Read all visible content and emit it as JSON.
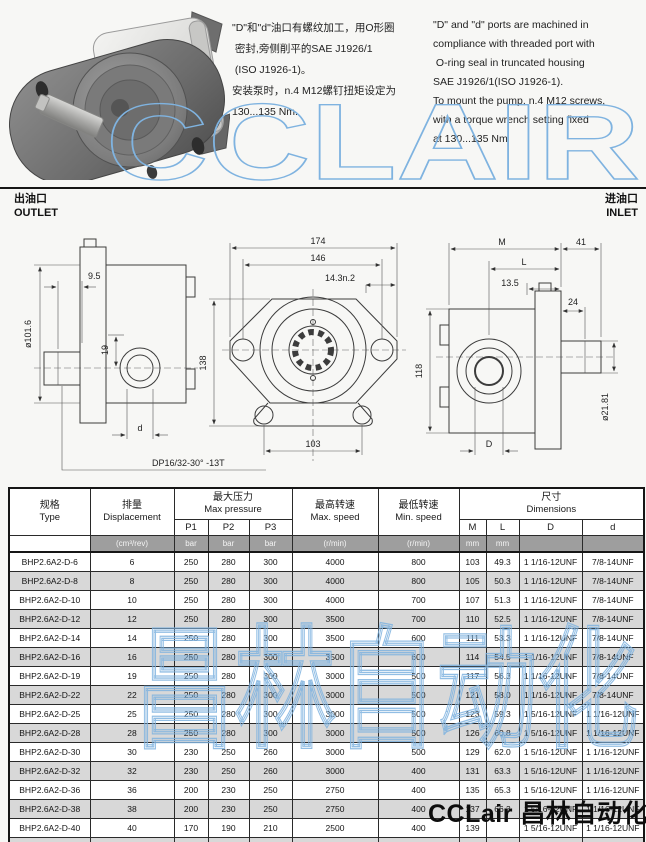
{
  "header": {
    "notes_zh": [
      "\"D\"和\"d\"油口有螺纹加工，用O形圈",
      " 密封,旁侧削平的SAE J1926/1",
      " (ISO J1926-1)。",
      "安装泵时，n.4 M12螺钉扭矩设定为",
      "130...135 Nm."
    ],
    "notes_en": [
      "\"D\" and \"d\" ports are machined in",
      "compliance with threaded port with",
      " O-ring seal in truncated housing",
      "SAE J1926/1(ISO J1926-1).",
      "To mount the pump, n.4 M12 screws,",
      "with a torque wrench setting fixed",
      "at 130...135 Nm"
    ]
  },
  "watermarks": {
    "brand_outline": "CCLAIR",
    "table_outline": "昌林自动化",
    "footer_black": "CCLair 昌林自动化",
    "outline_color": "#7fb3e0"
  },
  "ports": {
    "outlet_zh": "出油口",
    "outlet_en": "OUTLET",
    "inlet_zh": "进油口",
    "inlet_en": "INLET"
  },
  "drawing": {
    "dims": {
      "w95": "9.5",
      "dia1016": "ø101.6",
      "h19": "19",
      "h138": "138",
      "d_small": "d",
      "spline": "DP16/32-30°  -13T",
      "w174": "174",
      "w146": "146",
      "w143": "14.3n.2",
      "w103": "103",
      "M": "M",
      "w41": "41",
      "L": "L",
      "w135": "13.5",
      "w24": "24",
      "h118": "118",
      "dia2181": "ø21.81",
      "D_big": "D"
    }
  },
  "table": {
    "headers": {
      "type_zh": "规格",
      "type_en": "Type",
      "disp_zh": "排量",
      "disp_en": "Displacement",
      "press_zh": "最大压力",
      "press_en": "Max pressure",
      "p1": "P1",
      "p2": "P2",
      "p3": "P3",
      "maxspeed_zh": "最高转速",
      "maxspeed_en": "Max. speed",
      "minspeed_zh": "最低转速",
      "minspeed_en": "Min. speed",
      "dim_zh": "尺寸",
      "dim_en": "Dimensions",
      "m": "M",
      "l": "L",
      "d_upper": "D",
      "d_lower": "d"
    },
    "units": {
      "disp": "(cm³/rev)",
      "p1": "bar",
      "p2": "bar",
      "p3": "bar",
      "maxspeed": "(r/min)",
      "minspeed": "(r/min)",
      "m": "mm",
      "l": "mm",
      "d_upper": "",
      "d_lower": ""
    },
    "rows": [
      [
        "BHP2.6A2-D-6",
        "6",
        "250",
        "280",
        "300",
        "4000",
        "800",
        "103",
        "49.3",
        "1 1/16-12UNF",
        "7/8-14UNF"
      ],
      [
        "BHP2.6A2-D-8",
        "8",
        "250",
        "280",
        "300",
        "4000",
        "800",
        "105",
        "50.3",
        "1 1/16-12UNF",
        "7/8-14UNF"
      ],
      [
        "BHP2.6A2-D-10",
        "10",
        "250",
        "280",
        "300",
        "4000",
        "700",
        "107",
        "51.3",
        "1 1/16-12UNF",
        "7/8-14UNF"
      ],
      [
        "BHP2.6A2-D-12",
        "12",
        "250",
        "280",
        "300",
        "3500",
        "700",
        "110",
        "52.5",
        "1 1/16-12UNF",
        "7/8-14UNF"
      ],
      [
        "BHP2.6A2-D-14",
        "14",
        "250",
        "280",
        "300",
        "3500",
        "600",
        "111",
        "53.3",
        "1 1/16-12UNF",
        "7/8-14UNF"
      ],
      [
        "BHP2.6A2-D-16",
        "16",
        "250",
        "280",
        "300",
        "3500",
        "600",
        "114",
        "54.5",
        "1 1/16-12UNF",
        "7/8-14UNF"
      ],
      [
        "BHP2.6A2-D-19",
        "19",
        "250",
        "280",
        "300",
        "3000",
        "500",
        "117",
        "56.3",
        "1 1/16-12UNF",
        "7/8-14UNF"
      ],
      [
        "BHP2.6A2-D-22",
        "22",
        "250",
        "280",
        "300",
        "3000",
        "500",
        "121",
        "58.0",
        "1 1/16-12UNF",
        "7/8-14UNF"
      ],
      [
        "BHP2.6A2-D-25",
        "25",
        "250",
        "280",
        "300",
        "3000",
        "500",
        "123",
        "59.3",
        "1 5/16-12UNF",
        "1 1/16-12UNF"
      ],
      [
        "BHP2.6A2-D-28",
        "28",
        "250",
        "280",
        "300",
        "3000",
        "500",
        "126",
        "60.8",
        "1 5/16-12UNF",
        "1 1/16-12UNF"
      ],
      [
        "BHP2.6A2-D-30",
        "30",
        "230",
        "250",
        "260",
        "3000",
        "500",
        "129",
        "62.0",
        "1 5/16-12UNF",
        "1 1/16-12UNF"
      ],
      [
        "BHP2.6A2-D-32",
        "32",
        "230",
        "250",
        "260",
        "3000",
        "400",
        "131",
        "63.3",
        "1 5/16-12UNF",
        "1 1/16-12UNF"
      ],
      [
        "BHP2.6A2-D-36",
        "36",
        "200",
        "230",
        "250",
        "2750",
        "400",
        "135",
        "65.3",
        "1 5/16-12UNF",
        "1 1/16-12UNF"
      ],
      [
        "BHP2.6A2-D-38",
        "38",
        "200",
        "230",
        "250",
        "2750",
        "400",
        "137",
        "66.3",
        "1 5/16-12UNF",
        "1 1/16-12UNF"
      ],
      [
        "BHP2.6A2-D-40",
        "40",
        "170",
        "190",
        "210",
        "2500",
        "400",
        "139",
        "",
        "1 5/16-12UNF",
        "1 1/16-12UNF"
      ],
      [
        "BHP2.6A2-D-44",
        "44",
        "170",
        "190",
        "210",
        "2500",
        "400",
        "144",
        "69.5",
        "1 5/16-12UNF",
        "1 1/16-12UNF"
      ]
    ]
  }
}
